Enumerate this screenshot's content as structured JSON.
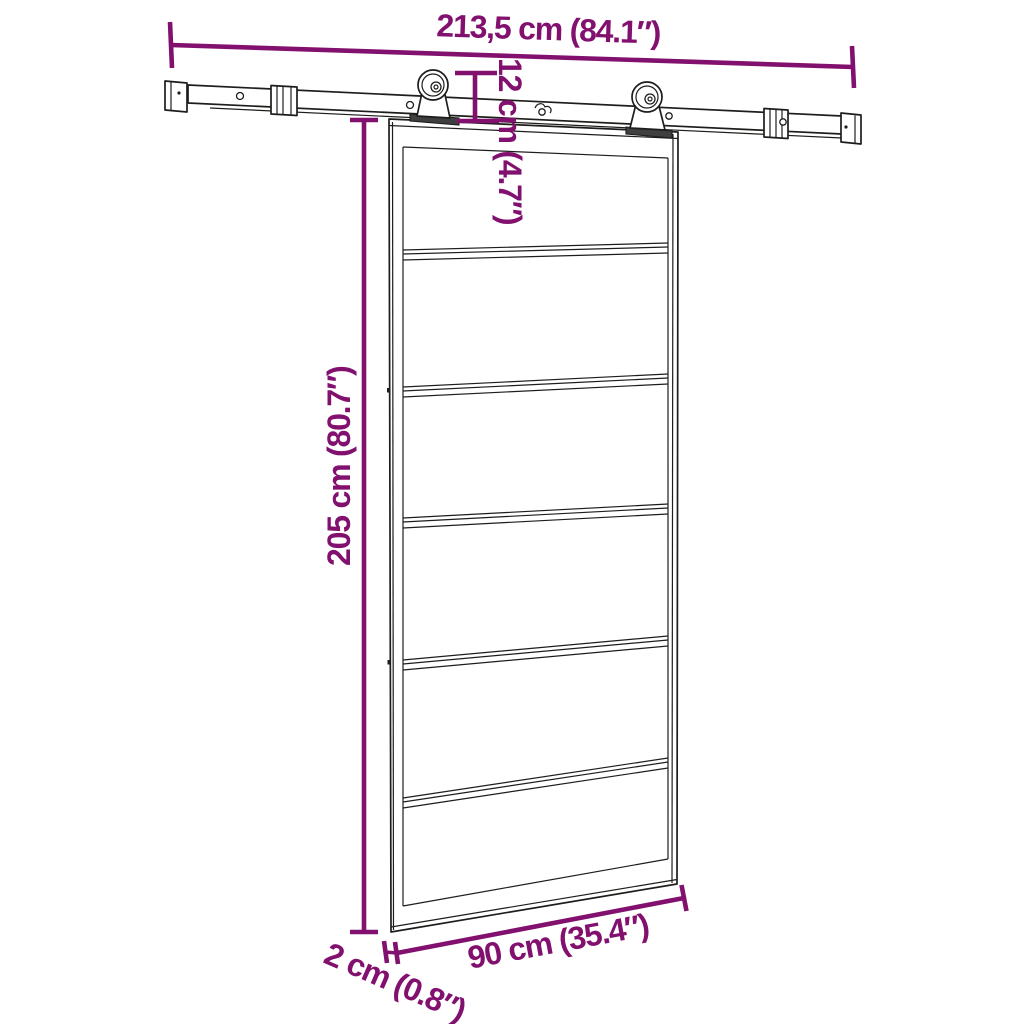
{
  "diagram": {
    "type": "product-dimension-diagram",
    "subject": "sliding-door-with-track-hardware",
    "colors": {
      "background": "#ffffff",
      "line_art": "#1d1d1b",
      "dimension": "#82106f"
    },
    "measurements": {
      "track_width": {
        "label": "213,5 cm (84.1″)",
        "cm": "213,5",
        "inches": "84.1"
      },
      "hanger_height": {
        "label": "12 cm (4.7″)",
        "cm": "12",
        "inches": "4.7"
      },
      "door_height": {
        "label": "205 cm (80.7″)",
        "cm": "205",
        "inches": "80.7"
      },
      "door_width": {
        "label": "90 cm (35.4″)",
        "cm": "90",
        "inches": "35.4"
      },
      "door_thickness": {
        "label": "2 cm (0.8″)",
        "cm": "2",
        "inches": "0.8"
      }
    }
  }
}
